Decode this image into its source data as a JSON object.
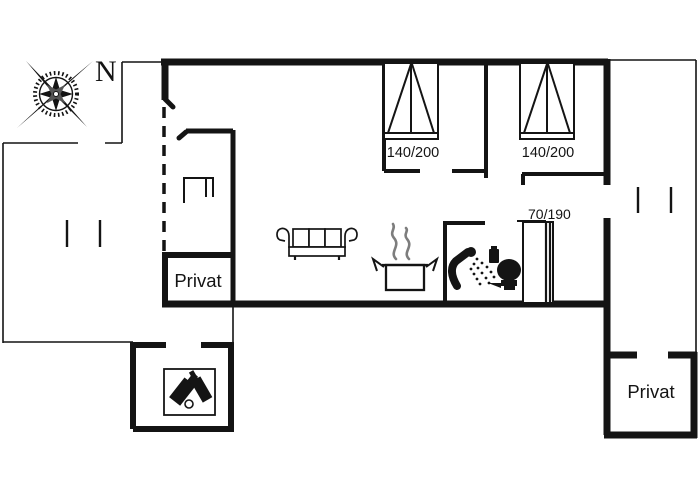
{
  "floor_plan": {
    "compass": {
      "north": "N"
    },
    "beds": {
      "double_1": "140/200",
      "double_2": "140/200",
      "single": "70/190"
    },
    "rooms": {
      "privat_left": "Privat",
      "privat_right": "Privat"
    },
    "icons": {
      "compass": "compass-rose",
      "living": "three-seat-sofa",
      "kitchen": "steaming-pot",
      "bathroom_shower": "shower-head",
      "bathroom_toilet": "toilet",
      "annex": "two-bottles",
      "entry": "closet-symbol"
    },
    "colors": {
      "line": "#141414",
      "steam": "#7d7d7d",
      "background": "#ffffff"
    }
  }
}
